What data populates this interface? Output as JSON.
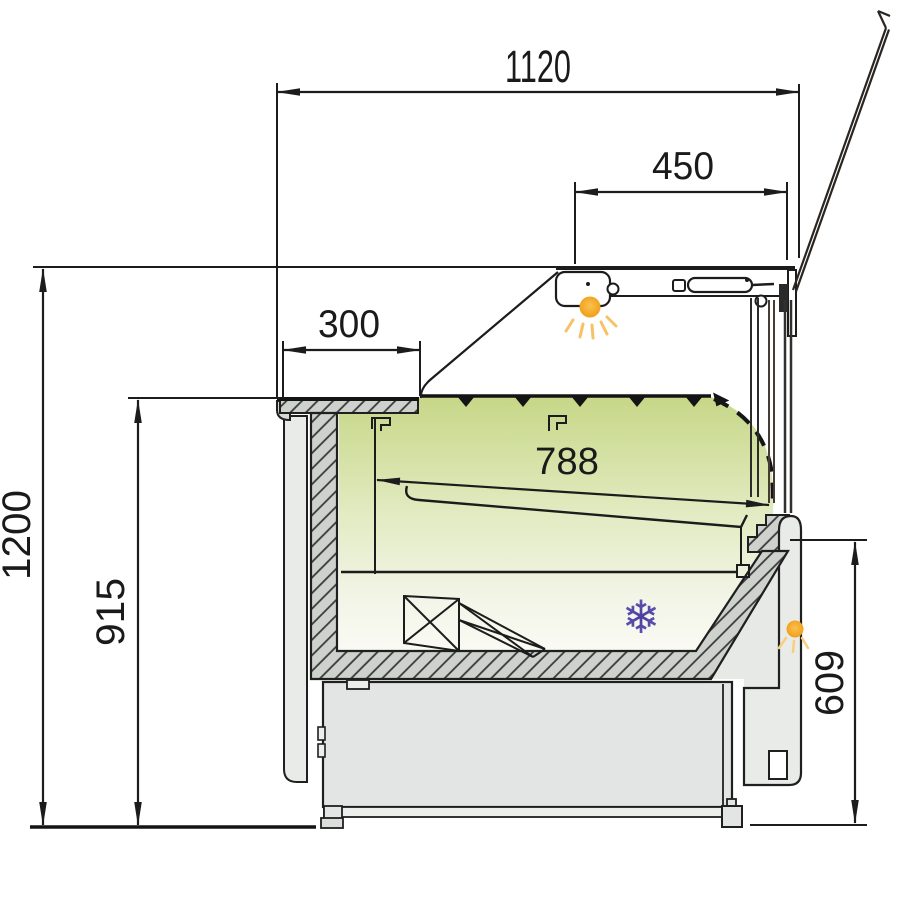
{
  "drawing": {
    "dimensions": {
      "overall_width": {
        "value": "1120"
      },
      "lid_glass_width": {
        "value": "450"
      },
      "worktop_depth": {
        "value": "300"
      },
      "display_deck_depth": {
        "value": "788"
      },
      "overall_height": {
        "value": "1200"
      },
      "worktop_height": {
        "value": "915"
      },
      "front_height": {
        "value": "609"
      }
    },
    "symbols": {
      "snowflake_glyph": "❄"
    },
    "colors": {
      "line": "#1c1c1c",
      "interior_green_top": "#c6d787",
      "interior_green_fade": "#fbfbf6",
      "light_orange_core": "#fbc14f",
      "light_orange_edge": "#ee9d14",
      "light_ray": "#f6c263",
      "snowflake_purple_core": "#4a3e9f",
      "snowflake_purple_mid": "#5b4fb0",
      "snowflake_purple_tip": "#9187d2",
      "hatch_fill": "#cdd2cd",
      "panel_gray": "#e9ebe9",
      "base_gray": "#e3e5e4"
    }
  }
}
